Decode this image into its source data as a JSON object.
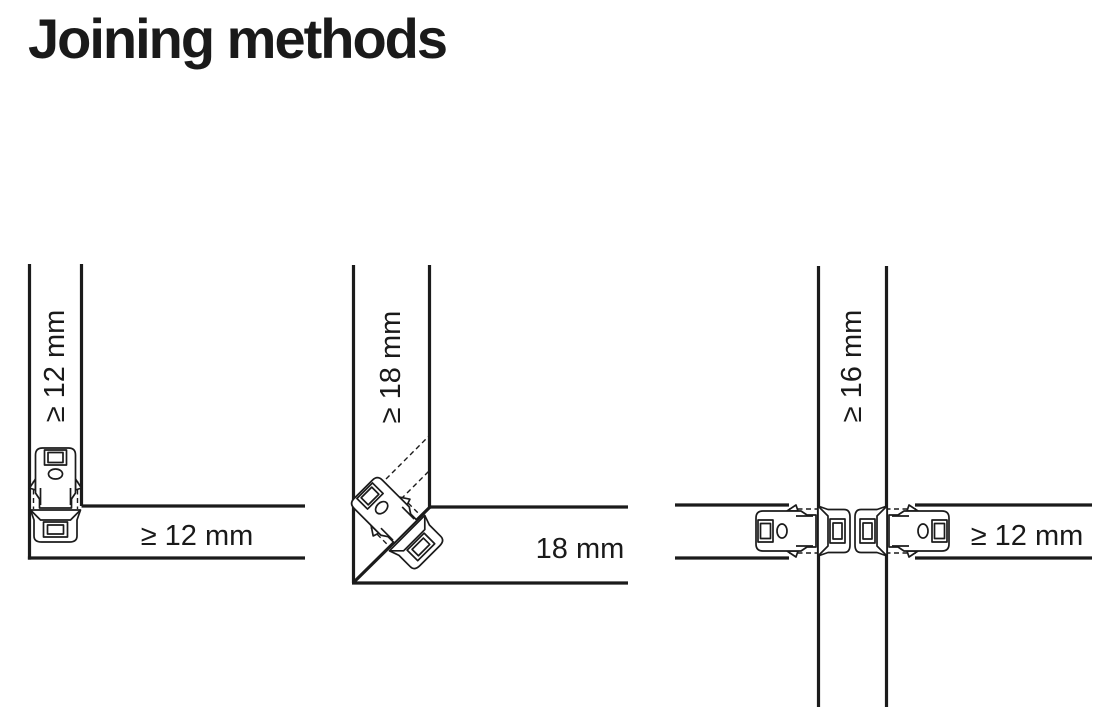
{
  "page": {
    "title": "Joining methods",
    "background": "#ffffff",
    "line_color": "#1b1b1b",
    "text_color": "#1a1a1a"
  },
  "diagrams": [
    {
      "name": "corner-butt-joint",
      "connector_icon": "cam-connector-icon",
      "vertical_panel_label": "≥ 12 mm",
      "horizontal_panel_label": "≥ 12 mm"
    },
    {
      "name": "miter-joint",
      "connector_icon": "cam-connector-icon",
      "vertical_panel_label": "≥ 18 mm",
      "horizontal_panel_label": "18 mm"
    },
    {
      "name": "cross-middle-panel-joint",
      "connector_icon": "cam-connector-icon",
      "vertical_panel_label": "≥ 16 mm",
      "horizontal_panel_label": "≥ 12 mm"
    }
  ]
}
